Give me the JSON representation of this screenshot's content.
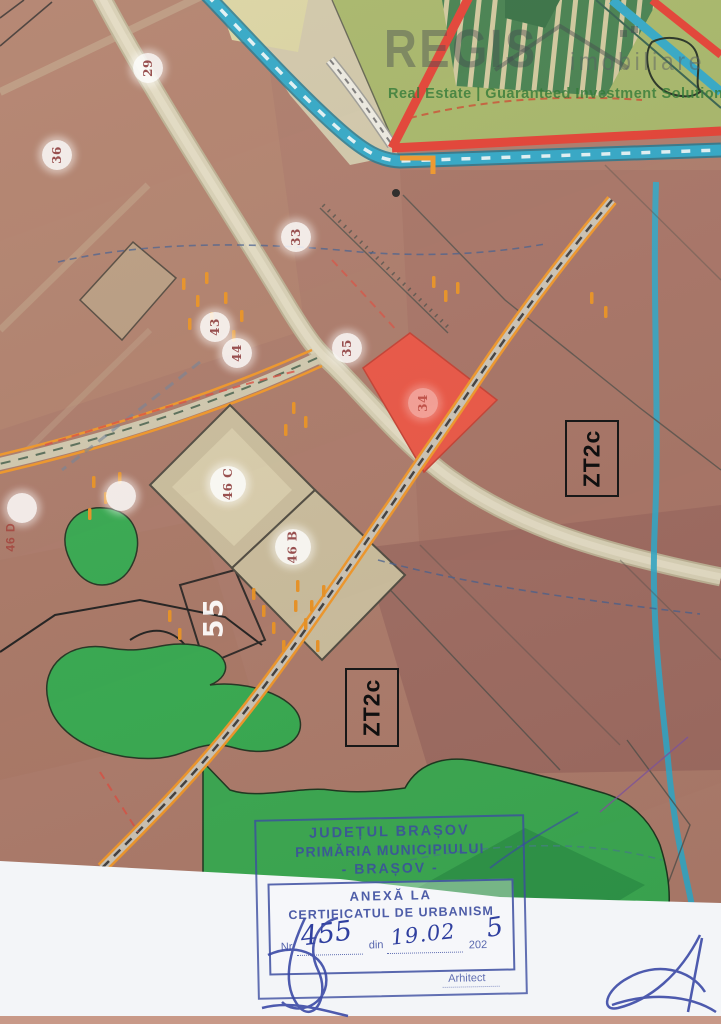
{
  "logo": {
    "name": "REGIS",
    "sub": "imobiliare",
    "tagline": "Real Estate | Guaranteed Investment Solutions"
  },
  "map": {
    "markers": [
      {
        "label": "29"
      },
      {
        "label": "36"
      },
      {
        "label": "33"
      },
      {
        "label": "43"
      },
      {
        "label": "44"
      },
      {
        "label": "35"
      },
      {
        "label": "34"
      },
      {
        "label": "46 C"
      },
      {
        "label": "46 B"
      },
      {
        "label": ""
      },
      {
        "label": ""
      }
    ],
    "zones": [
      {
        "label": "ZT2c"
      },
      {
        "label": "ZT2c"
      }
    ],
    "area_label": "55",
    "side_label": "46 D",
    "colors": {
      "base_brown": "#a97767",
      "pasture_green": "#a3b465",
      "forest_green": "#33a64d",
      "road_beige": "#d3cbb0",
      "water_cyan": "#29a5c6",
      "road_red": "#e23a2e",
      "rail_orange": "#ef9424",
      "highlight_parcel_red": "#ea5140",
      "stamp_blue": "#3c4da0"
    }
  },
  "stamp": {
    "line1": "JUDEȚUL BRAȘOV",
    "line2": "PRIMĂRIA MUNICIPIULUI",
    "line3": "- BRAȘOV -",
    "line4": "ANEXĂ LA",
    "line5": "CERTIFICATUL DE URBANISM",
    "nr_label": "Nr",
    "nr_value": "455",
    "din_label": "din",
    "date_value": "19.02",
    "year_printed": "202",
    "year_written": "5",
    "signed_by": "Arhitect"
  }
}
